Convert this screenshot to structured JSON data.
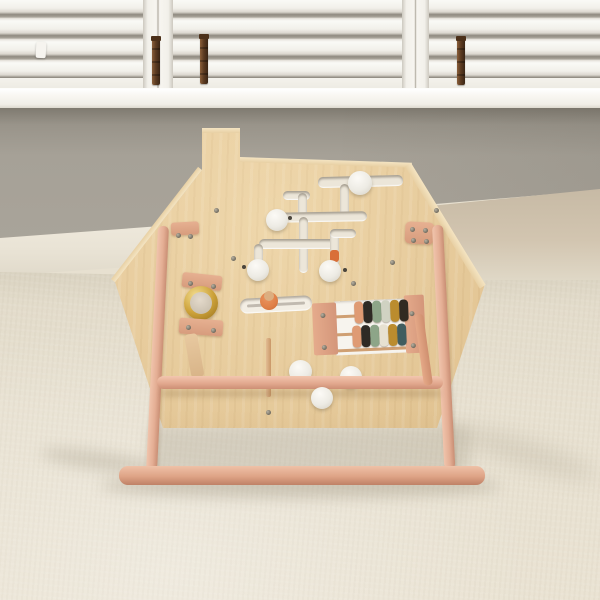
{
  "scene": {
    "subject": "wooden house-shaped activity busy-board on a pink wooden stand",
    "setting": "room with white plantation shutters, grey wall, white baseboard and beige carpet"
  },
  "palette": {
    "shutter_white": "#f2efe9",
    "sill_white": "#f8f6f1",
    "rod_brown": "#5d3c22",
    "wall_gray": "#a39e94",
    "baseboard_white": "#ece7da",
    "wall_band_tan": "#cfc2ad",
    "carpet_beige": "#e7e0d0",
    "wood_light": "#e9cda0",
    "wood_main": "#e2c392",
    "wood_dark": "#d9b883",
    "wood_edge": "#f1dfba",
    "stand_pink": "#e6b298",
    "stand_pink_dark": "#cf9177",
    "bracket_salmon": "#dda486",
    "track_white": "#ece6d9",
    "knob_white": "#f4f1ea",
    "gold": "#c9a035",
    "ring_inner": "#d9cfc0",
    "slider_orange": "#df7f46",
    "peg_tan": "#dcae80",
    "bead_orange": "#d96f38",
    "strap_tan": "#dcb287",
    "screw_gray": "#6f6a5e",
    "shadow": "#7d735c"
  },
  "window": {
    "shutter_panels": 3,
    "tilt_rods": 3,
    "louver_gaps_per_panel": 4
  },
  "toy": {
    "board_shape": "house with chimney",
    "maze": {
      "white_slider_knobs": 4,
      "orange_bead": "#d96f38"
    },
    "lower_knobs": 3,
    "mirror": {
      "ring_color": "#c9a035",
      "inner_color": "#d9cfc0"
    },
    "slider_slot": {
      "knob_color": "#df7f46",
      "peg_color": "#dcae80"
    },
    "abacus": {
      "rows": 2,
      "beads_per_row": 6,
      "top_row": [
        "#df9b74",
        "#2e2a25",
        "#8da588",
        "#d0d2c2",
        "#bb8c2e",
        "#322b22"
      ],
      "bottom_row": [
        "#df9b74",
        "#2e2a25",
        "#8da588",
        "#e7e1d1",
        "#bb8c2e",
        "#415d5f"
      ],
      "panel_white": "#f7f4ee",
      "post_salmon": "#dd9f80",
      "rod_color": "#cf9f72"
    },
    "stand": {
      "legs": 2,
      "crossbar": 1,
      "floor_bar": 1,
      "color": "#e6b298"
    }
  }
}
